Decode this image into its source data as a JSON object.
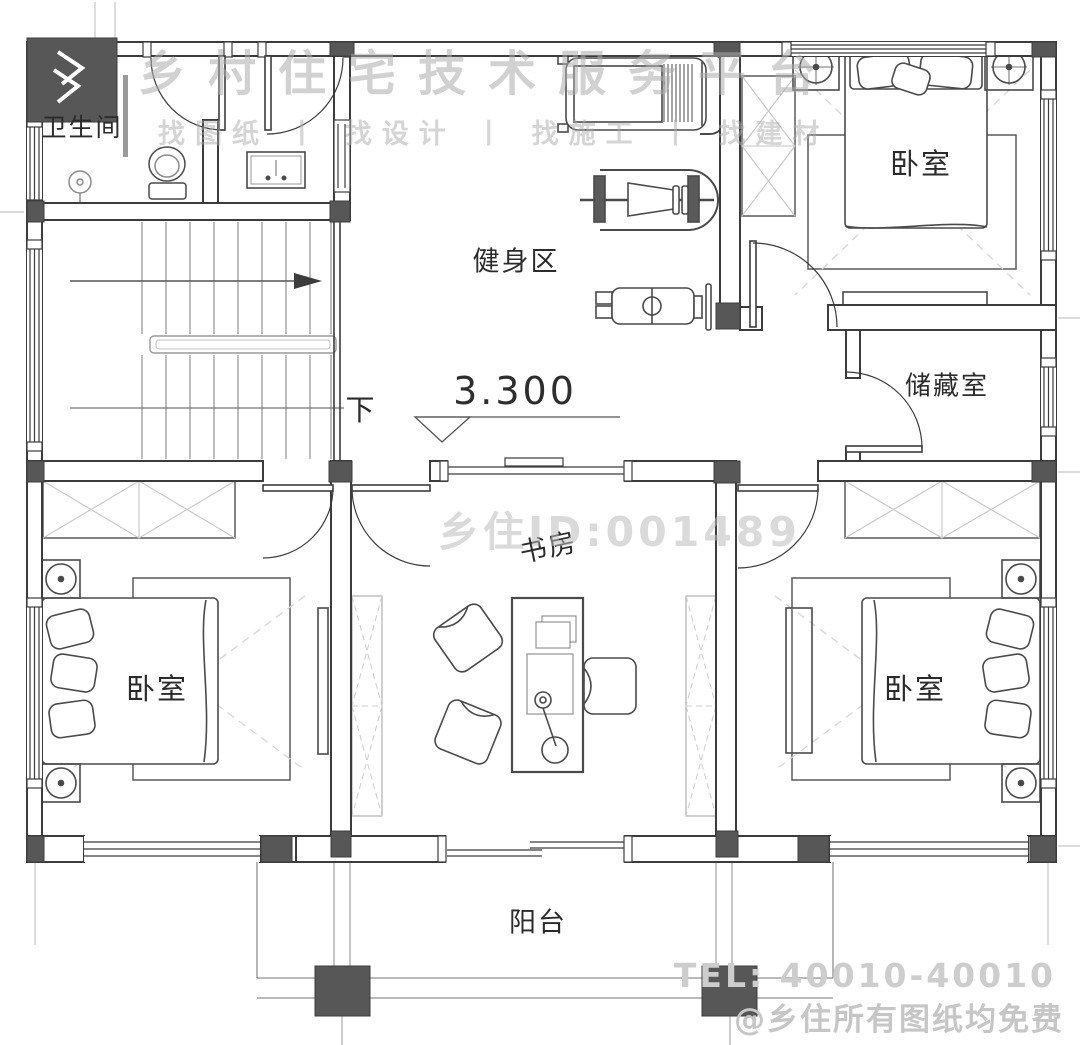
{
  "branding": {
    "platform_name": "乡村住宅技术服务平台",
    "tagline": "找图纸 丨 找设计 丨 找施工 丨 找建材",
    "watermark_id": "乡住ID:001489",
    "tel": "TEL: 40010-40010",
    "footer_note": "@乡住所有图纸均免费"
  },
  "rooms": {
    "bathroom": "卫生间",
    "gym": "健身区",
    "bedroom_top_right": "卧室",
    "storage": "储藏室",
    "study": "书房",
    "bedroom_bottom_left": "卧室",
    "bedroom_bottom_right": "卧室",
    "balcony": "阳台"
  },
  "annotations": {
    "stairs_direction": "下",
    "elevation": "3.300"
  },
  "colors": {
    "wall_line": "#3c3c3c",
    "column_fill": "#575757",
    "hatch_line": "#c6c6c6",
    "stair_line": "#9a9a9a",
    "watermark_gray": "#c8c8c8",
    "label_ink": "#2b2b2b"
  }
}
